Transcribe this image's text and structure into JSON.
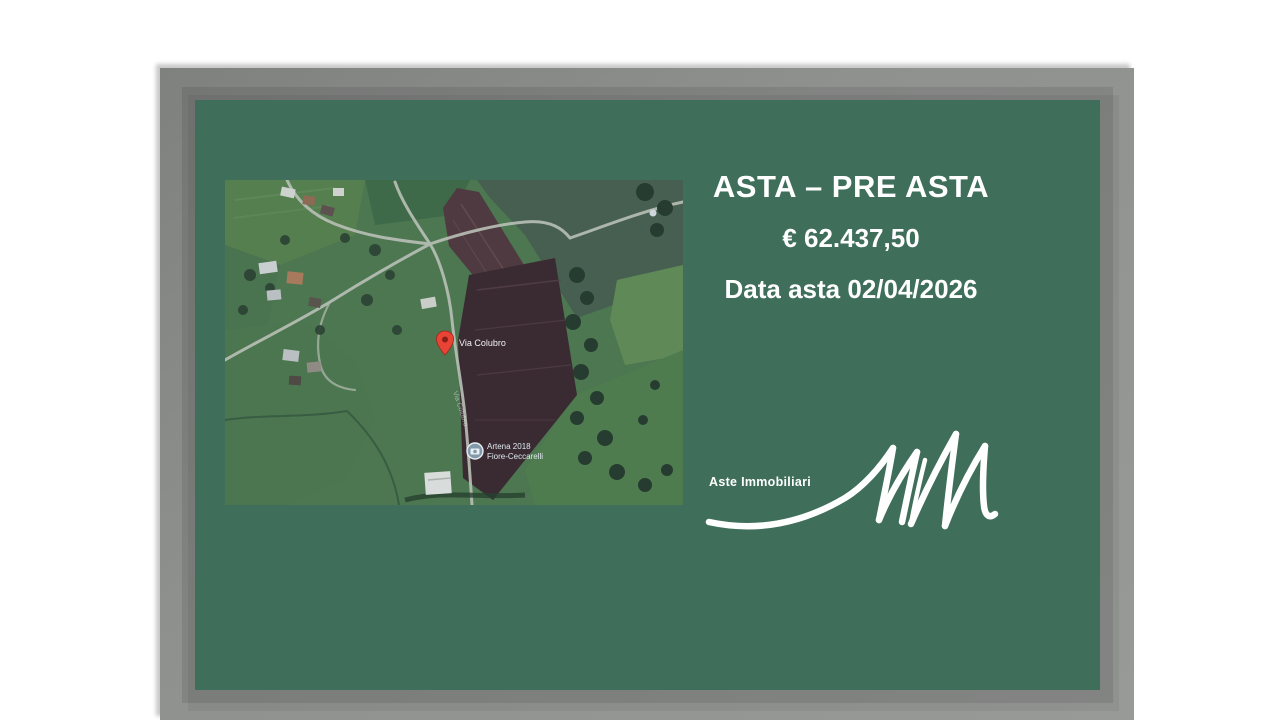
{
  "slide": {
    "title": "ASTA – PRE ASTA",
    "price": "€ 62.437,50",
    "date": "Data asta 02/04/2026"
  },
  "map": {
    "marker_label": "Via Colubro",
    "street_label": "Via Colubro",
    "photo_label_line1": "Artena 2018",
    "photo_label_line2": "Fiore-Ceccarelli"
  },
  "logo": {
    "text": "Aste Immobiliari",
    "monogram": "MM"
  },
  "colors": {
    "slide_background": "#3f6e5b",
    "frame_gray": "#8f918f",
    "text_white": "#ffffff",
    "marker_red": "#e94335"
  }
}
